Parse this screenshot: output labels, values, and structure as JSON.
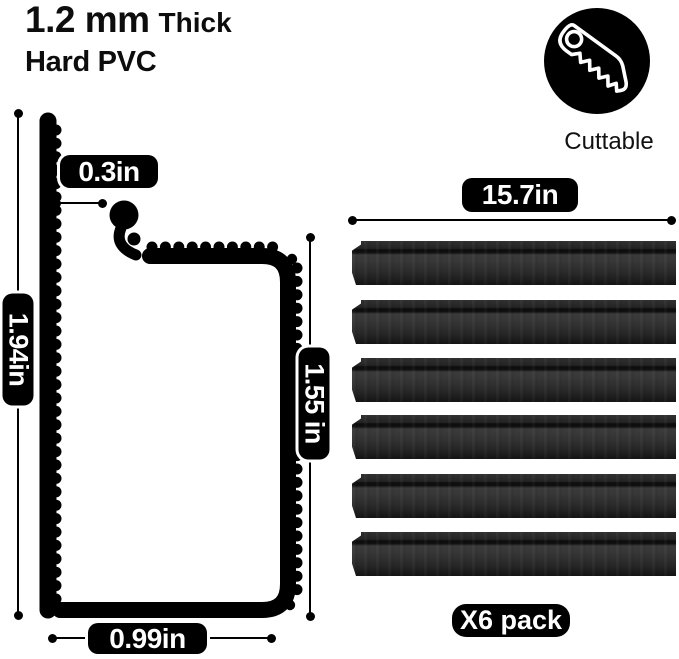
{
  "header": {
    "thickness_value": "1.2 mm",
    "thickness_label": "Thick",
    "material": "Hard PVC"
  },
  "cuttable": {
    "label": "Cuttable",
    "icon": "saw-icon",
    "badge_color": "#000000"
  },
  "diagram": {
    "total_height": "1.94in",
    "top_opening": "0.3in",
    "inner_height": "1.55 in",
    "bottom_width": "0.99in",
    "ink_color": "#000000"
  },
  "pack": {
    "strip_length": "15.7in",
    "pack_label": "X6 pack",
    "strip_count": 6,
    "strip_color_dark": "#141414",
    "strip_color_mid": "#373737"
  }
}
